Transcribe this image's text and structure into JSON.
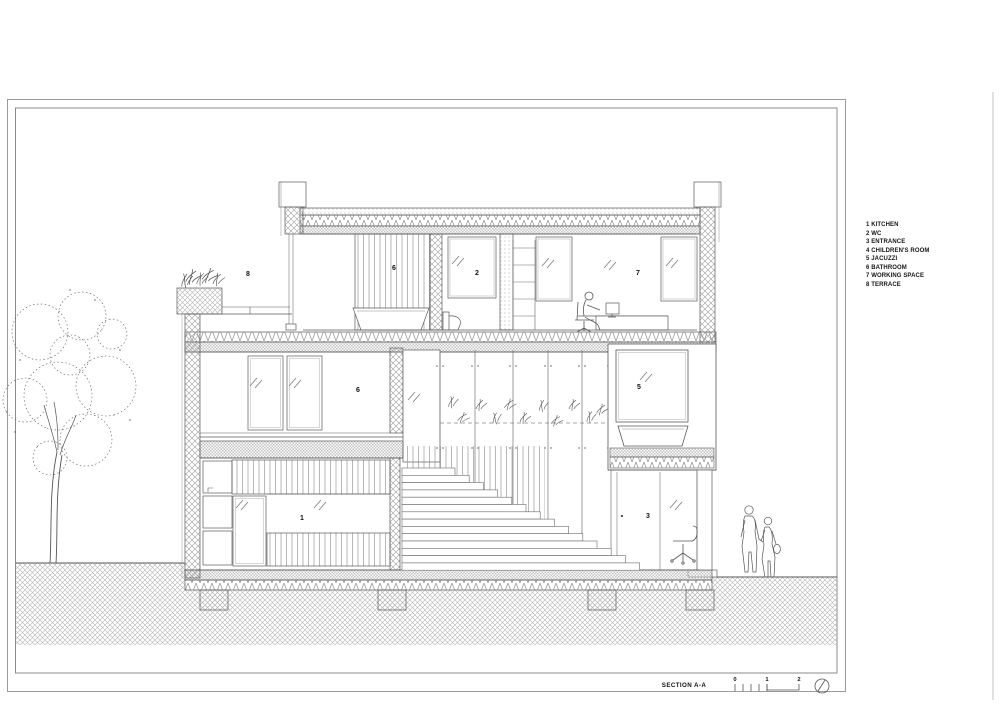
{
  "sheet": {
    "section_title": "SECTION A-A",
    "scale": {
      "marks": [
        "0",
        "1",
        "2"
      ]
    },
    "legend": {
      "items": [
        "1 KITCHEN",
        "2 WC",
        "3 ENTRANCE",
        "4 CHILDREN'S ROOM",
        "5 JACUZZI",
        "6 BATHROOM",
        "7 WORKING SPACE",
        "8 TERRACE"
      ]
    },
    "room_labels": {
      "terrace": "8",
      "bathroom_upper": "6",
      "wc": "2",
      "working_space": "7",
      "bathroom_mid": "6",
      "jacuzzi": "5",
      "kitchen": "1",
      "entrance": "3"
    },
    "figures": [
      "tree",
      "planter-plants",
      "green-wall-plants",
      "person-at-desk",
      "office-chair",
      "walking-couple"
    ]
  }
}
